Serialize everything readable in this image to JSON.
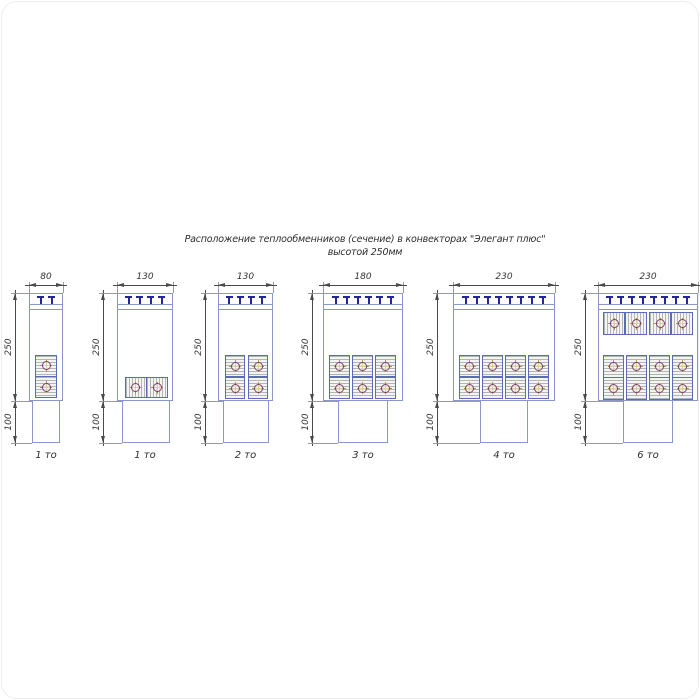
{
  "title": {
    "line1": "Расположение теплообменников (сечение) в конвекторах \"Элегант плюс\"",
    "line2": "высотой 250мм"
  },
  "colors": {
    "outline": "#8a97cc",
    "block_border": "#5a6cb8",
    "block_fill": "#f4f4f4",
    "hatch": "#b4b4b4",
    "tmark": "#23269b",
    "dim_line": "#4a4a4a",
    "ext_line": "#9a9a9a",
    "text": "#2e2e2e",
    "tube_circle": "#7b3f63",
    "tube_cross": "#b8903a",
    "background": "#ffffff"
  },
  "diagrams": [
    {
      "name": "convector-80-1to",
      "width_label": "80",
      "height_labels": [
        "250",
        "100"
      ],
      "count_label": "1 то",
      "t_marks": 2,
      "tube_count": 2,
      "geometry": {
        "box": {
          "x": 29,
          "y": 293,
          "w": 34,
          "h": 108
        },
        "pedestal": {
          "x": 32,
          "w": 28,
          "h": 42
        },
        "dim_x": 15,
        "blocks": [
          {
            "o": "v",
            "x": 35,
            "y": 355,
            "w": 22,
            "h": 43
          }
        ]
      }
    },
    {
      "name": "convector-130-1to",
      "width_label": "130",
      "height_labels": [
        "250",
        "100"
      ],
      "count_label": "1 то",
      "t_marks": 4,
      "tube_count": 2,
      "geometry": {
        "box": {
          "x": 117,
          "y": 293,
          "w": 56,
          "h": 108
        },
        "pedestal": {
          "x": 122,
          "w": 48,
          "h": 42
        },
        "dim_x": 103,
        "blocks": [
          {
            "o": "h",
            "x": 125,
            "y": 377,
            "w": 43,
            "h": 21
          }
        ]
      }
    },
    {
      "name": "convector-130-2to",
      "width_label": "130",
      "height_labels": [
        "250",
        "100"
      ],
      "count_label": "2 то",
      "t_marks": 4,
      "tube_count": 4,
      "geometry": {
        "box": {
          "x": 218,
          "y": 293,
          "w": 55,
          "h": 108
        },
        "pedestal": {
          "x": 223,
          "w": 46,
          "h": 42
        },
        "dim_x": 205,
        "blocks": [
          {
            "o": "v",
            "x": 225,
            "y": 355,
            "w": 20,
            "h": 44
          },
          {
            "o": "v",
            "x": 248,
            "y": 355,
            "w": 20,
            "h": 44
          }
        ]
      }
    },
    {
      "name": "convector-180-3to",
      "width_label": "180",
      "height_labels": [
        "250",
        "100"
      ],
      "count_label": "3 то",
      "t_marks": 6,
      "tube_count": 6,
      "geometry": {
        "box": {
          "x": 323,
          "y": 293,
          "w": 80,
          "h": 108
        },
        "pedestal": {
          "x": 338,
          "w": 50,
          "h": 42
        },
        "dim_x": 312,
        "blocks": [
          {
            "o": "v",
            "x": 329,
            "y": 355,
            "w": 21,
            "h": 44
          },
          {
            "o": "v",
            "x": 352,
            "y": 355,
            "w": 21,
            "h": 44
          },
          {
            "o": "v",
            "x": 375,
            "y": 355,
            "w": 21,
            "h": 44
          }
        ]
      }
    },
    {
      "name": "convector-230-4to",
      "width_label": "230",
      "height_labels": [
        "250",
        "100"
      ],
      "count_label": "4 то",
      "t_marks": 8,
      "tube_count": 8,
      "geometry": {
        "box": {
          "x": 453,
          "y": 293,
          "w": 102,
          "h": 108
        },
        "pedestal": {
          "x": 480,
          "w": 48,
          "h": 42
        },
        "dim_x": 437,
        "blocks": [
          {
            "o": "v",
            "x": 459,
            "y": 355,
            "w": 21,
            "h": 44
          },
          {
            "o": "v",
            "x": 482,
            "y": 355,
            "w": 21,
            "h": 44
          },
          {
            "o": "v",
            "x": 505,
            "y": 355,
            "w": 21,
            "h": 44
          },
          {
            "o": "v",
            "x": 528,
            "y": 355,
            "w": 21,
            "h": 44
          }
        ]
      }
    },
    {
      "name": "convector-230-6to",
      "width_label": "230",
      "height_labels": [
        "250",
        "100"
      ],
      "count_label": "6 то",
      "t_marks": 8,
      "tube_count": 12,
      "geometry": {
        "box": {
          "x": 598,
          "y": 293,
          "w": 100,
          "h": 108
        },
        "pedestal": {
          "x": 623,
          "w": 50,
          "h": 42
        },
        "dim_x": 585,
        "blocks": [
          {
            "o": "h",
            "x": 603,
            "y": 312,
            "w": 44,
            "h": 23
          },
          {
            "o": "h",
            "x": 649,
            "y": 312,
            "w": 44,
            "h": 23
          },
          {
            "o": "v",
            "x": 603,
            "y": 355,
            "w": 21,
            "h": 45
          },
          {
            "o": "v",
            "x": 626,
            "y": 355,
            "w": 21,
            "h": 45
          },
          {
            "o": "v",
            "x": 649,
            "y": 355,
            "w": 21,
            "h": 45
          },
          {
            "o": "v",
            "x": 672,
            "y": 355,
            "w": 21,
            "h": 45
          }
        ]
      }
    }
  ]
}
